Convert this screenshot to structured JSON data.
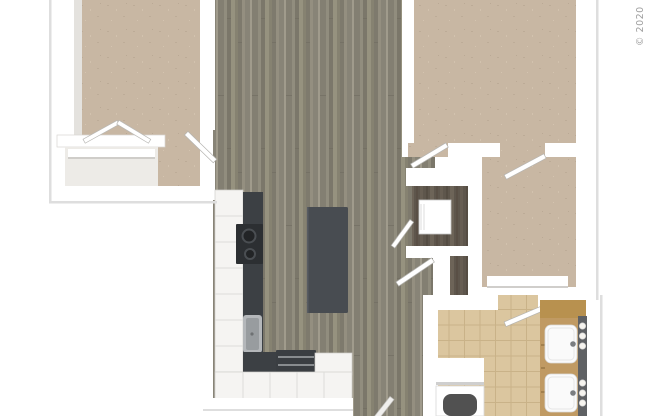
{
  "watermark": {
    "text": "© 2020"
  },
  "palette": {
    "background": "#ffffff",
    "wall": "#ffffff",
    "wall_face": "#e4e2de",
    "wall_shadow": "#dedede",
    "plank_floor": "#8d8a7d",
    "carpet": "#c8b7a3",
    "closet_floor": "#edebe7",
    "tile": "#dbc69f",
    "tile_grout": "#c9b288",
    "dark_wood": "#5e564c",
    "counter_dark": "#3c4044",
    "island_dark": "#484c51",
    "cabinet_white": "#f5f4f2",
    "appliance_dark": "#3a3e42",
    "range_black": "#2c2f32",
    "stainless": "#b4b7ba",
    "vanity_wood": "#c09a63",
    "vanity_wood_top": "#b8914f",
    "light_strip": "#5f6164",
    "fixture_white": "#fafafa",
    "tub_interior": "#515151",
    "watermark_gray": "#9e9e9e"
  },
  "floorplan": {
    "rooms": [
      "living-dining-area",
      "kitchen",
      "bedroom-1",
      "bedroom-2",
      "walk-in-closet",
      "bathroom",
      "laundry-closet",
      "linen-closet",
      "bedroom-1-closet"
    ],
    "fixtures": [
      "kitchen-island",
      "range-cooktop",
      "kitchen-sink",
      "refrigerator",
      "washer-dryer-unit",
      "double-vanity",
      "vanity-sinks",
      "vanity-light-strip",
      "bathtub",
      "bath-shelf",
      "closet-bench",
      "closet-shelf-rod",
      "swing-doors",
      "bifold-closet-doors"
    ],
    "floor_finishes": {
      "living_kitchen": "gray wood plank",
      "bedrooms_closets": "beige carpet",
      "bathroom": "tan ceramic tile",
      "utility_closets": "dark wood"
    }
  }
}
